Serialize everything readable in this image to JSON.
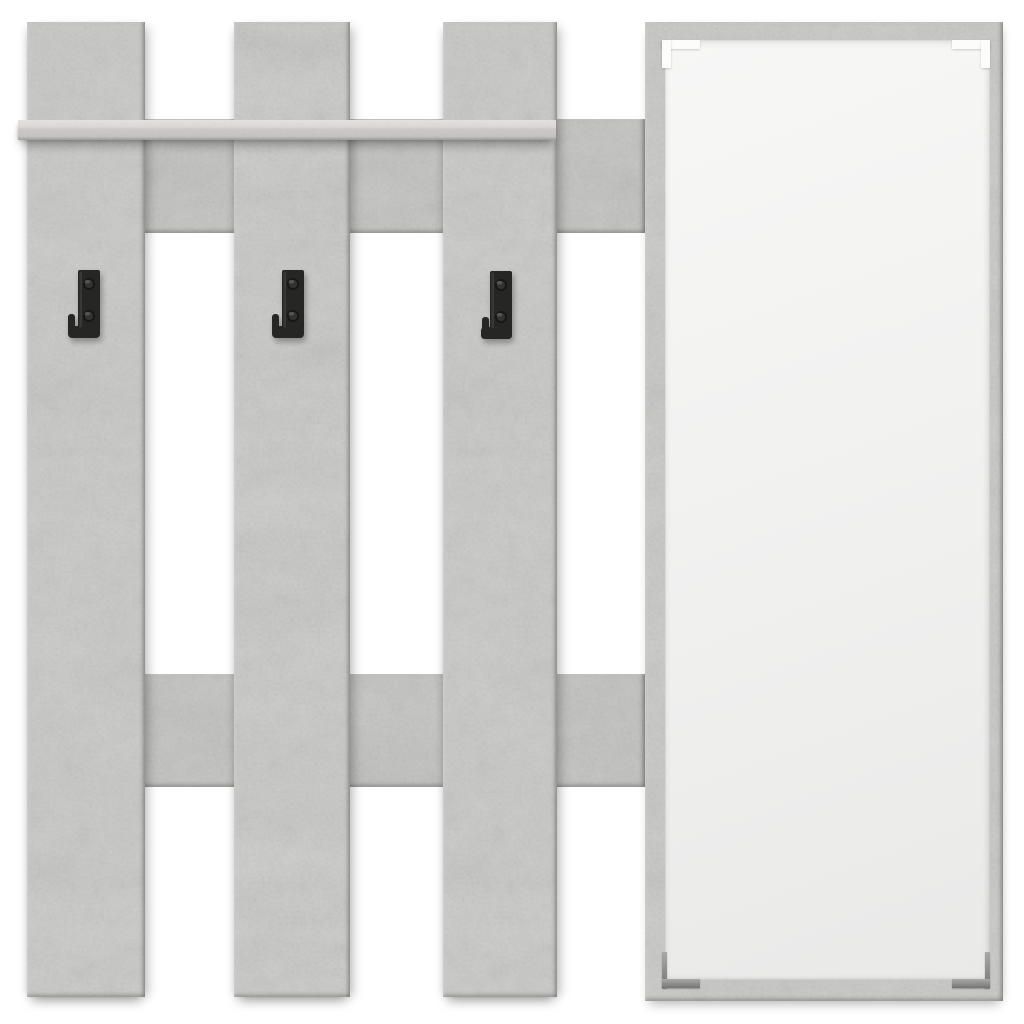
{
  "scene": {
    "type": "product-photo",
    "subject": "Wall-mounted hallway coat rack made of three vertical concrete-grey planks with a shelf, two horizontal rails, three black metal coat hooks and a tall rectangular mirror panel",
    "background_color": "#ffffff"
  },
  "materials": {
    "panel_color": "#c9c9c7",
    "panel_color_light": "#dadad8",
    "panel_color_dark": "#c2c2c0",
    "material_name": "concrete grey wood-effect board",
    "hook_color": "#262624",
    "mirror_color": "#f1f1f0",
    "clip_color_top": "#fcfcfb",
    "clip_color_bottom": "#8f8f8d",
    "shadow_color": "rgba(0,0,0,0.25)"
  },
  "components": {
    "planks": {
      "count": 3,
      "orientation": "vertical",
      "label": "vertical plank"
    },
    "rails": {
      "count": 2,
      "orientation": "horizontal",
      "label": "horizontal cross rail"
    },
    "shelf": {
      "count": 1,
      "label": "top shelf"
    },
    "hooks": {
      "count": 3,
      "screws_per_hook": 2,
      "label": "black J-shaped coat hook"
    },
    "mirror": {
      "count": 1,
      "corner_clips": 4,
      "label": "frameless mirror with corner clips"
    }
  }
}
